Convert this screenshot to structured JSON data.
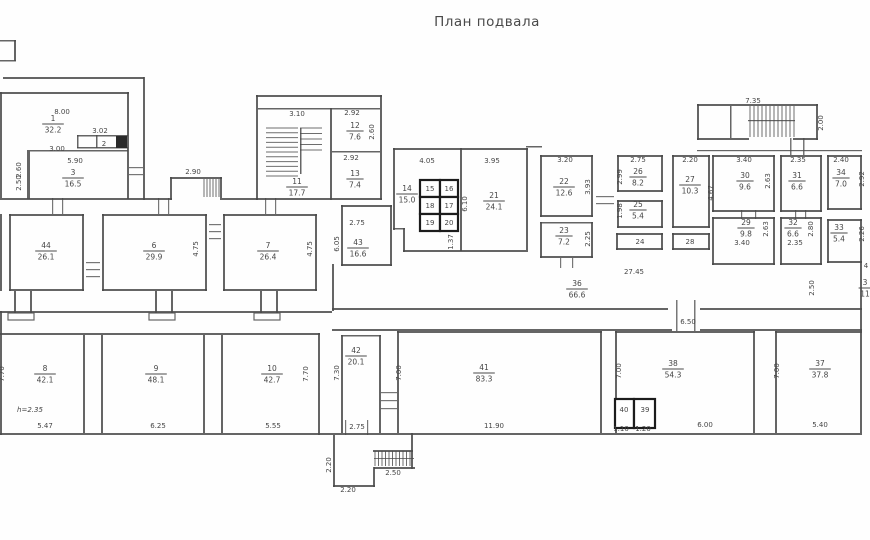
{
  "title": "План подвала",
  "canvas": {
    "w": 870,
    "h": 540,
    "ink": "#4a4a4a",
    "cell_ink": "#1c1c1c",
    "paper": "#fefefe"
  },
  "rooms": [
    {
      "n": "1",
      "a": "32.2",
      "x": 53,
      "y": 123
    },
    {
      "n": "3",
      "a": "16.5",
      "x": 73,
      "y": 177
    },
    {
      "n": "44",
      "a": "26.1",
      "x": 46,
      "y": 250
    },
    {
      "n": "6",
      "a": "29.9",
      "x": 154,
      "y": 250
    },
    {
      "n": "7",
      "a": "26.4",
      "x": 268,
      "y": 250
    },
    {
      "n": "11",
      "a": "17.7",
      "x": 297,
      "y": 186
    },
    {
      "n": "12",
      "a": "7.6",
      "x": 355,
      "y": 130
    },
    {
      "n": "13",
      "a": "7.4",
      "x": 355,
      "y": 178
    },
    {
      "n": "14",
      "a": "15.0",
      "x": 407,
      "y": 193
    },
    {
      "n": "21",
      "a": "24.1",
      "x": 494,
      "y": 200
    },
    {
      "n": "43",
      "a": "16.6",
      "x": 358,
      "y": 247
    },
    {
      "n": "22",
      "a": "12.6",
      "x": 564,
      "y": 186
    },
    {
      "n": "23",
      "a": "7.2",
      "x": 564,
      "y": 235
    },
    {
      "n": "26",
      "a": "8.2",
      "x": 638,
      "y": 176
    },
    {
      "n": "25",
      "a": "5.4",
      "x": 638,
      "y": 209
    },
    {
      "n": "27",
      "a": "10.3",
      "x": 690,
      "y": 184
    },
    {
      "n": "36",
      "a": "66.6",
      "x": 577,
      "y": 288
    },
    {
      "n": "30",
      "a": "9.6",
      "x": 745,
      "y": 180
    },
    {
      "n": "31",
      "a": "6.6",
      "x": 797,
      "y": 180
    },
    {
      "n": "34",
      "a": "7.0",
      "x": 841,
      "y": 177
    },
    {
      "n": "29",
      "a": "9.8",
      "x": 746,
      "y": 227
    },
    {
      "n": "32",
      "a": "6.6",
      "x": 793,
      "y": 227
    },
    {
      "n": "33",
      "a": "5.4",
      "x": 839,
      "y": 232
    },
    {
      "n": "8",
      "a": "42.1",
      "x": 45,
      "y": 373
    },
    {
      "n": "9",
      "a": "48.1",
      "x": 156,
      "y": 373
    },
    {
      "n": "10",
      "a": "42.7",
      "x": 272,
      "y": 373
    },
    {
      "n": "42",
      "a": "20.1",
      "x": 356,
      "y": 355
    },
    {
      "n": "41",
      "a": "83.3",
      "x": 484,
      "y": 372
    },
    {
      "n": "38",
      "a": "54.3",
      "x": 673,
      "y": 368
    },
    {
      "n": "37",
      "a": "37.8",
      "x": 820,
      "y": 368
    },
    {
      "n": "3",
      "a": "11",
      "x": 865,
      "y": 287
    }
  ],
  "plain_labels": [
    {
      "t": "2",
      "x": 104,
      "y": 146
    },
    {
      "t": "24",
      "x": 640,
      "y": 244
    },
    {
      "t": "28",
      "x": 690,
      "y": 244
    },
    {
      "t": "15",
      "x": 430,
      "y": 191
    },
    {
      "t": "16",
      "x": 449,
      "y": 191
    },
    {
      "t": "18",
      "x": 430,
      "y": 208
    },
    {
      "t": "17",
      "x": 449,
      "y": 208
    },
    {
      "t": "19",
      "x": 430,
      "y": 225
    },
    {
      "t": "20",
      "x": 449,
      "y": 225
    },
    {
      "t": "40",
      "x": 624,
      "y": 412
    },
    {
      "t": "39",
      "x": 645,
      "y": 412
    },
    {
      "t": "4",
      "x": 866,
      "y": 268
    }
  ],
  "dims": [
    {
      "t": "8.00",
      "x": 62,
      "y": 114
    },
    {
      "t": "3.02",
      "x": 100,
      "y": 133
    },
    {
      "t": "3.00",
      "x": 57,
      "y": 151
    },
    {
      "t": "5.90",
      "x": 75,
      "y": 163
    },
    {
      "t": "2.90",
      "x": 193,
      "y": 174
    },
    {
      "t": "3.10",
      "x": 297,
      "y": 116
    },
    {
      "t": "2.92",
      "x": 352,
      "y": 115
    },
    {
      "t": "2.92",
      "x": 351,
      "y": 160
    },
    {
      "t": "4.05",
      "x": 427,
      "y": 163
    },
    {
      "t": "3.95",
      "x": 492,
      "y": 163
    },
    {
      "t": "3.20",
      "x": 565,
      "y": 162
    },
    {
      "t": "2.75",
      "x": 638,
      "y": 162
    },
    {
      "t": "2.20",
      "x": 690,
      "y": 162
    },
    {
      "t": "7.35",
      "x": 753,
      "y": 103
    },
    {
      "t": "3.40",
      "x": 744,
      "y": 162
    },
    {
      "t": "2.35",
      "x": 798,
      "y": 162
    },
    {
      "t": "2.40",
      "x": 841,
      "y": 162
    },
    {
      "t": "3.40",
      "x": 742,
      "y": 245
    },
    {
      "t": "2.35",
      "x": 795,
      "y": 245
    },
    {
      "t": "2.75",
      "x": 357,
      "y": 225
    },
    {
      "t": "27.45",
      "x": 634,
      "y": 274
    },
    {
      "t": "6.50",
      "x": 688,
      "y": 324
    },
    {
      "t": "5.47",
      "x": 45,
      "y": 428
    },
    {
      "t": "6.25",
      "x": 158,
      "y": 428
    },
    {
      "t": "5.55",
      "x": 273,
      "y": 428
    },
    {
      "t": "2.75",
      "x": 357,
      "y": 429
    },
    {
      "t": "11.90",
      "x": 494,
      "y": 428
    },
    {
      "t": "6.00",
      "x": 705,
      "y": 427
    },
    {
      "t": "5.40",
      "x": 820,
      "y": 427
    },
    {
      "t": "1.10",
      "x": 621,
      "y": 431
    },
    {
      "t": "1.20",
      "x": 643,
      "y": 431
    },
    {
      "t": "2.50",
      "x": 393,
      "y": 475
    },
    {
      "t": "2.20",
      "x": 348,
      "y": 492
    }
  ],
  "note": {
    "t": "h=2.35",
    "x": 30,
    "y": 412
  },
  "vdims": [
    {
      "t": "2.60",
      "x": 21,
      "y": 170
    },
    {
      "t": "2.50",
      "x": 21,
      "y": 183
    },
    {
      "t": "2.60",
      "x": 374,
      "y": 132
    },
    {
      "t": "4.75",
      "x": 198,
      "y": 249
    },
    {
      "t": "4.75",
      "x": 312,
      "y": 249
    },
    {
      "t": "6.10",
      "x": 467,
      "y": 204
    },
    {
      "t": "1.37",
      "x": 453,
      "y": 242
    },
    {
      "t": "3.93",
      "x": 590,
      "y": 187
    },
    {
      "t": "2.25",
      "x": 590,
      "y": 239
    },
    {
      "t": "2.99",
      "x": 622,
      "y": 177
    },
    {
      "t": "1.98",
      "x": 622,
      "y": 211
    },
    {
      "t": "4.67",
      "x": 713,
      "y": 193
    },
    {
      "t": "2.00",
      "x": 823,
      "y": 123
    },
    {
      "t": "2.63",
      "x": 770,
      "y": 181
    },
    {
      "t": "2.92",
      "x": 864,
      "y": 179
    },
    {
      "t": "2.63",
      "x": 768,
      "y": 229
    },
    {
      "t": "2.80",
      "x": 813,
      "y": 229
    },
    {
      "t": "2.26",
      "x": 864,
      "y": 234
    },
    {
      "t": "2.50",
      "x": 814,
      "y": 288
    },
    {
      "t": "7.70",
      "x": 308,
      "y": 374
    },
    {
      "t": "7.70",
      "x": 4,
      "y": 374
    },
    {
      "t": "7.30",
      "x": 339,
      "y": 373
    },
    {
      "t": "7.00",
      "x": 401,
      "y": 373
    },
    {
      "t": "7.00",
      "x": 621,
      "y": 371
    },
    {
      "t": "7.00",
      "x": 779,
      "y": 371
    },
    {
      "t": "2.20",
      "x": 331,
      "y": 465
    },
    {
      "t": "6.05",
      "x": 339,
      "y": 244
    }
  ],
  "walls": [
    [
      3,
      77,
      141,
      2
    ],
    [
      143,
      77,
      2,
      123
    ],
    [
      0,
      92,
      129,
      2
    ],
    [
      127,
      92,
      2,
      107
    ],
    [
      27,
      150,
      3,
      49
    ],
    [
      30,
      150,
      98,
      1.5
    ],
    [
      0,
      198,
      172,
      2
    ],
    [
      222,
      198,
      36,
      2
    ],
    [
      77,
      135,
      51,
      1.5
    ],
    [
      77,
      147,
      51,
      1.5
    ],
    [
      77,
      135,
      1.5,
      13
    ],
    [
      96,
      135,
      1.5,
      13
    ],
    [
      170,
      177,
      52,
      2
    ],
    [
      170,
      177,
      2,
      23
    ],
    [
      220,
      177,
      2,
      23
    ],
    [
      9,
      214,
      75,
      2
    ],
    [
      9,
      214,
      2,
      77
    ],
    [
      82,
      214,
      2,
      77
    ],
    [
      9,
      289,
      75,
      2
    ],
    [
      102,
      214,
      105,
      2
    ],
    [
      102,
      214,
      2,
      77
    ],
    [
      205,
      214,
      2,
      77
    ],
    [
      102,
      289,
      105,
      2
    ],
    [
      223,
      214,
      94,
      2
    ],
    [
      223,
      214,
      2,
      77
    ],
    [
      315,
      214,
      2,
      77
    ],
    [
      223,
      289,
      94,
      2
    ],
    [
      0,
      311,
      332,
      2
    ],
    [
      14,
      291,
      2,
      22
    ],
    [
      30,
      291,
      2,
      22
    ],
    [
      155,
      291,
      2,
      22
    ],
    [
      171,
      291,
      2,
      22
    ],
    [
      260,
      291,
      2,
      22
    ],
    [
      276,
      291,
      2,
      22
    ],
    [
      256,
      95,
      126,
      2
    ],
    [
      256,
      95,
      2,
      105
    ],
    [
      380,
      95,
      2,
      105
    ],
    [
      258,
      108,
      122,
      1.5
    ],
    [
      330,
      108,
      2,
      92
    ],
    [
      332,
      151,
      48,
      1.5
    ],
    [
      256,
      198,
      126,
      2
    ],
    [
      300,
      128,
      1.5,
      46
    ],
    [
      393,
      148,
      135,
      2
    ],
    [
      393,
      148,
      2,
      82
    ],
    [
      526,
      148,
      2,
      104
    ],
    [
      460,
      148,
      2,
      103
    ],
    [
      403,
      250,
      123,
      2
    ],
    [
      393,
      228,
      12,
      1.5
    ],
    [
      403,
      228,
      2,
      24
    ],
    [
      341,
      205,
      51,
      2
    ],
    [
      341,
      205,
      2,
      61
    ],
    [
      390,
      205,
      2,
      61
    ],
    [
      341,
      264,
      51,
      2
    ],
    [
      332,
      264,
      2,
      47
    ],
    [
      332,
      308,
      336,
      2
    ],
    [
      700,
      308,
      162,
      2
    ],
    [
      332,
      329,
      340,
      2
    ],
    [
      700,
      329,
      162,
      2
    ],
    [
      540,
      155,
      53,
      2
    ],
    [
      540,
      155,
      2,
      62
    ],
    [
      591,
      155,
      2,
      62
    ],
    [
      540,
      215,
      53,
      2
    ],
    [
      540,
      222,
      53,
      1.5
    ],
    [
      540,
      222,
      2,
      36
    ],
    [
      591,
      222,
      2,
      36
    ],
    [
      540,
      256,
      53,
      2
    ],
    [
      617,
      155,
      46,
      2
    ],
    [
      617,
      155,
      2,
      37
    ],
    [
      661,
      155,
      2,
      37
    ],
    [
      617,
      190,
      46,
      2
    ],
    [
      617,
      200,
      46,
      2
    ],
    [
      617,
      200,
      2,
      28
    ],
    [
      661,
      200,
      2,
      28
    ],
    [
      617,
      226,
      46,
      2
    ],
    [
      616,
      233,
      47,
      2
    ],
    [
      616,
      233,
      2,
      17
    ],
    [
      661,
      233,
      2,
      17
    ],
    [
      616,
      248,
      47,
      2
    ],
    [
      672,
      155,
      38,
      2
    ],
    [
      672,
      155,
      2,
      73
    ],
    [
      708,
      155,
      2,
      73
    ],
    [
      672,
      226,
      38,
      2
    ],
    [
      672,
      233,
      38,
      2
    ],
    [
      672,
      233,
      2,
      17
    ],
    [
      708,
      233,
      2,
      17
    ],
    [
      672,
      248,
      38,
      2
    ],
    [
      526,
      146,
      16,
      1.5
    ],
    [
      697,
      104,
      121,
      2
    ],
    [
      697,
      104,
      2,
      36
    ],
    [
      816,
      104,
      2,
      36
    ],
    [
      697,
      138,
      52,
      2
    ],
    [
      793,
      138,
      25,
      2
    ],
    [
      730,
      106,
      1.5,
      32
    ],
    [
      748,
      120,
      47,
      1.2
    ],
    [
      697,
      150,
      165,
      1.2
    ],
    [
      712,
      155,
      63,
      2
    ],
    [
      712,
      155,
      2,
      57
    ],
    [
      773,
      155,
      2,
      57
    ],
    [
      712,
      210,
      63,
      2
    ],
    [
      780,
      155,
      42,
      2
    ],
    [
      780,
      155,
      2,
      57
    ],
    [
      820,
      155,
      2,
      57
    ],
    [
      780,
      210,
      42,
      2
    ],
    [
      827,
      155,
      35,
      2
    ],
    [
      827,
      155,
      2,
      55
    ],
    [
      860,
      155,
      2,
      55
    ],
    [
      827,
      208,
      35,
      2
    ],
    [
      712,
      217,
      63,
      2
    ],
    [
      712,
      217,
      2,
      48
    ],
    [
      773,
      217,
      2,
      48
    ],
    [
      712,
      263,
      63,
      2
    ],
    [
      780,
      217,
      42,
      2
    ],
    [
      780,
      217,
      2,
      48
    ],
    [
      820,
      217,
      2,
      48
    ],
    [
      780,
      263,
      42,
      2
    ],
    [
      827,
      219,
      35,
      2
    ],
    [
      827,
      219,
      2,
      44
    ],
    [
      860,
      219,
      2,
      44
    ],
    [
      827,
      261,
      35,
      2
    ],
    [
      860,
      263,
      2,
      68
    ],
    [
      0,
      333,
      320,
      2
    ],
    [
      318,
      333,
      2,
      102
    ],
    [
      0,
      433,
      862,
      2
    ],
    [
      83,
      335,
      2,
      98
    ],
    [
      101,
      335,
      2,
      98
    ],
    [
      203,
      335,
      2,
      98
    ],
    [
      221,
      335,
      2,
      98
    ],
    [
      341,
      335,
      2,
      98
    ],
    [
      379,
      335,
      2,
      98
    ],
    [
      341,
      335,
      40,
      1.5
    ],
    [
      397,
      331,
      205,
      2
    ],
    [
      397,
      331,
      2,
      102
    ],
    [
      600,
      331,
      2,
      102
    ],
    [
      615,
      331,
      140,
      2
    ],
    [
      615,
      331,
      2,
      102
    ],
    [
      753,
      331,
      2,
      102
    ],
    [
      775,
      331,
      87,
      2
    ],
    [
      775,
      331,
      2,
      102
    ],
    [
      860,
      331,
      2,
      102
    ],
    [
      333,
      435,
      2,
      52
    ],
    [
      333,
      485,
      42,
      2
    ],
    [
      373,
      467,
      2,
      20
    ],
    [
      373,
      450,
      40,
      2
    ],
    [
      374,
      467,
      41,
      2
    ],
    [
      411,
      450,
      2,
      19
    ],
    [
      411,
      433,
      2,
      17
    ],
    [
      0,
      40,
      16,
      1.5
    ],
    [
      0,
      60,
      16,
      1.5
    ],
    [
      14,
      40,
      2,
      21
    ],
    [
      0,
      92,
      2,
      106
    ],
    [
      0,
      214,
      2,
      77
    ],
    [
      0,
      311,
      2,
      124
    ]
  ],
  "plates": [
    [
      8,
      313,
      26,
      7
    ],
    [
      149,
      313,
      26,
      7
    ],
    [
      254,
      313,
      26,
      7
    ]
  ],
  "thick_cells": [
    [
      420,
      180,
      20,
      17
    ],
    [
      440,
      180,
      18,
      17
    ],
    [
      420,
      197,
      20,
      17
    ],
    [
      440,
      197,
      18,
      17
    ],
    [
      420,
      214,
      20,
      17
    ],
    [
      440,
      214,
      18,
      17
    ],
    [
      615,
      399,
      19,
      29
    ],
    [
      634,
      399,
      21,
      29
    ]
  ],
  "dark_fills": [
    [
      116,
      136,
      11,
      12
    ]
  ],
  "stairs": [
    {
      "x": 266,
      "y": 128,
      "w": 32,
      "h": 48,
      "dir": "h",
      "n": 11
    },
    {
      "x": 300,
      "y": 128,
      "w": 22,
      "h": 22,
      "dir": "h",
      "n": 5
    },
    {
      "x": 750,
      "y": 106,
      "w": 44,
      "h": 31,
      "dir": "v",
      "n": 12
    },
    {
      "x": 204,
      "y": 179,
      "w": 15,
      "h": 18,
      "dir": "v",
      "n": 6
    },
    {
      "x": 375,
      "y": 451,
      "w": 35,
      "h": 15,
      "dir": "v",
      "n": 11
    }
  ],
  "ticks": [
    [
      86,
      262,
      14,
      1.2
    ],
    [
      86,
      269,
      14,
      1.2
    ],
    [
      86,
      276,
      14,
      1.2
    ],
    [
      209,
      224,
      12,
      1.2
    ],
    [
      209,
      231,
      12,
      1.2
    ],
    [
      209,
      238,
      12,
      1.2
    ],
    [
      129,
      167,
      14,
      1.2
    ],
    [
      129,
      174,
      14,
      1.2
    ],
    [
      596,
      196,
      18,
      1.2
    ],
    [
      596,
      203,
      18,
      1.2
    ],
    [
      381,
      392,
      16,
      1.2
    ],
    [
      381,
      400,
      16,
      1.2
    ],
    [
      381,
      408,
      16,
      1.2
    ],
    [
      676,
      300,
      1.5,
      31
    ],
    [
      694,
      300,
      1.5,
      31
    ],
    [
      345,
      420,
      1.2,
      15
    ],
    [
      367,
      420,
      1.2,
      15
    ],
    [
      560,
      258,
      1.2,
      10
    ],
    [
      572,
      258,
      1.2,
      10
    ],
    [
      790,
      138,
      1.5,
      17
    ],
    [
      803,
      138,
      1.5,
      17
    ],
    [
      741,
      210,
      1.2,
      9
    ],
    [
      755,
      210,
      1.2,
      9
    ],
    [
      795,
      210,
      1.2,
      9
    ],
    [
      805,
      210,
      1.2,
      9
    ],
    [
      52,
      198,
      1.2,
      16
    ],
    [
      62,
      198,
      1.2,
      16
    ],
    [
      158,
      198,
      1.2,
      16
    ],
    [
      168,
      198,
      1.2,
      16
    ],
    [
      265,
      198,
      1.2,
      16
    ],
    [
      275,
      198,
      1.2,
      16
    ],
    [
      374,
      458,
      40,
      1
    ]
  ]
}
